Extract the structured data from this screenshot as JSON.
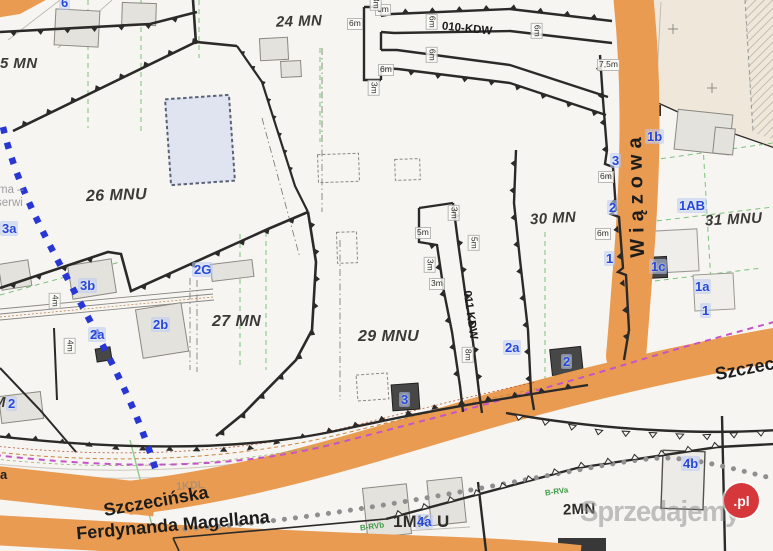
{
  "zones": {
    "z5": "5 MN",
    "z24": "24 MN",
    "z26": "26 MNU",
    "z27": "27 MN",
    "z29": "29 MNU",
    "z30": "30 MN",
    "z31": "31 MNU",
    "z1mku_a": "1MK",
    "z1mku_b": "U",
    "z2mn": "2MN",
    "zM": "M"
  },
  "roads": {
    "wiazowa": "Wiązowa",
    "szczecinska": "Szczecińska",
    "ferdynanda": "Ferdynanda Magellana",
    "r010": "010-KDW",
    "r011": "011 KDW",
    "r1kdl": "1KDL",
    "left_partial": "a"
  },
  "parcels": {
    "p6": "6",
    "p3a": "3a",
    "p2g": "2G",
    "p3b": "3b",
    "p2b": "2b",
    "p2a": "2a",
    "p2": "2",
    "p3": "3",
    "p1": "1",
    "p1b": "1b",
    "p1ab": "1AB",
    "p1c": "1c",
    "p1a": "1a",
    "p4a": "4a",
    "p4b": "4b"
  },
  "dim": {
    "m6": "6m",
    "m3": "3m",
    "m5": "5m",
    "m8": "8m",
    "m4": "4m",
    "m75": "7,5m"
  },
  "soil": {
    "b_rvb": "B-RVb",
    "b_rva": "B-RVa"
  },
  "watermark": {
    "brand": "Sprzedajemy",
    "tld": ".pl",
    "left_line1": "ma –",
    "left_line2": "serwi"
  },
  "colors": {
    "bg": "#f6f5f2",
    "road": "#ea9b52",
    "ink": "#2b2a28",
    "zone_text": "#3b3a36",
    "parcel_blue": "#2447d8",
    "magenta": "#c653c8",
    "blue_dot": "#2836d4",
    "green": "#7cc17c",
    "bldg": "#e4e2dd",
    "bldg_blue": "#dfe4f0",
    "beige": "#efe8da",
    "wm_red": "#d5373b",
    "wm_gray": "#8d8d8d"
  }
}
